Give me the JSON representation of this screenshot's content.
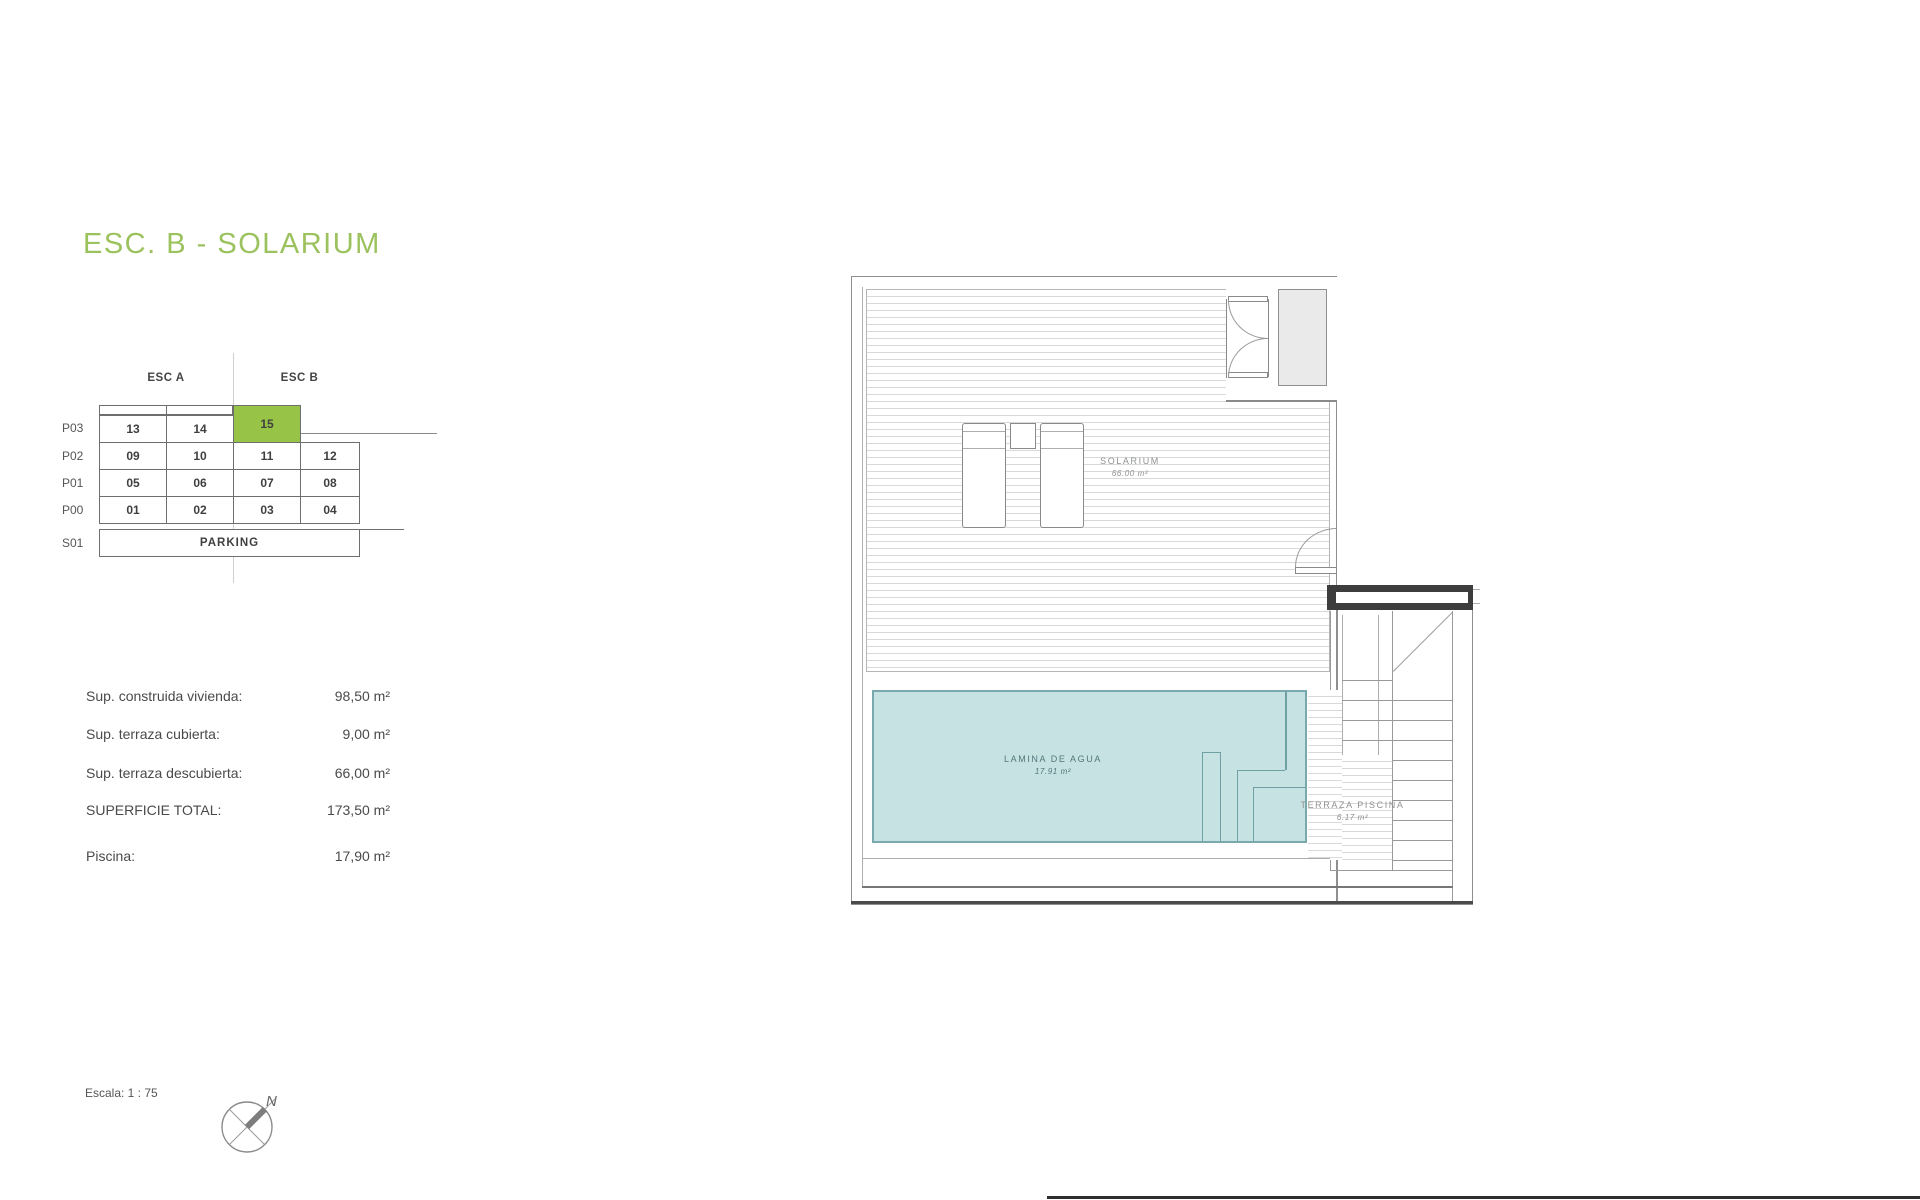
{
  "document": {
    "title": "ESC. B - SOLARIUM"
  },
  "stack_diagram": {
    "col_headers": [
      "ESC A",
      "ESC B"
    ],
    "rows": [
      {
        "label": "P03",
        "cells": [
          "13",
          "14",
          "15"
        ]
      },
      {
        "label": "P02",
        "cells": [
          "09",
          "10",
          "11",
          "12"
        ]
      },
      {
        "label": "P01",
        "cells": [
          "05",
          "06",
          "07",
          "08"
        ]
      },
      {
        "label": "P00",
        "cells": [
          "01",
          "02",
          "03",
          "04"
        ]
      },
      {
        "label": "S01",
        "cells": [
          "PARKING"
        ]
      }
    ],
    "highlighted_unit": "15"
  },
  "surface_table": {
    "rows": [
      {
        "label": "Sup. construida vivienda:",
        "value": "98,50 m²"
      },
      {
        "label": "Sup. terraza cubierta:",
        "value": "9,00 m²"
      },
      {
        "label": "Sup. terraza descubierta:",
        "value": "66,00 m²"
      },
      {
        "label": "SUPERFICIE TOTAL:",
        "value": "173,50 m²"
      },
      {
        "label": "Piscina:",
        "value": "17,90 m²"
      }
    ]
  },
  "plan": {
    "solarium": {
      "name": "SOLARIUM",
      "area": "66.00 m²"
    },
    "pool": {
      "name": "LAMINA DE AGUA",
      "area": "17.91 m²"
    },
    "pool_terrace": {
      "name": "TERRAZA PISCINA",
      "area": "6.17 m²"
    }
  },
  "footer": {
    "scale_label": "Escala: 1 : 75",
    "north_label": "N"
  },
  "colors": {
    "accent_green": "#9CC25E",
    "highlight_green": "#97C447",
    "pool_fill": "#C6E2E3",
    "pool_border": "#7AA9AD"
  }
}
